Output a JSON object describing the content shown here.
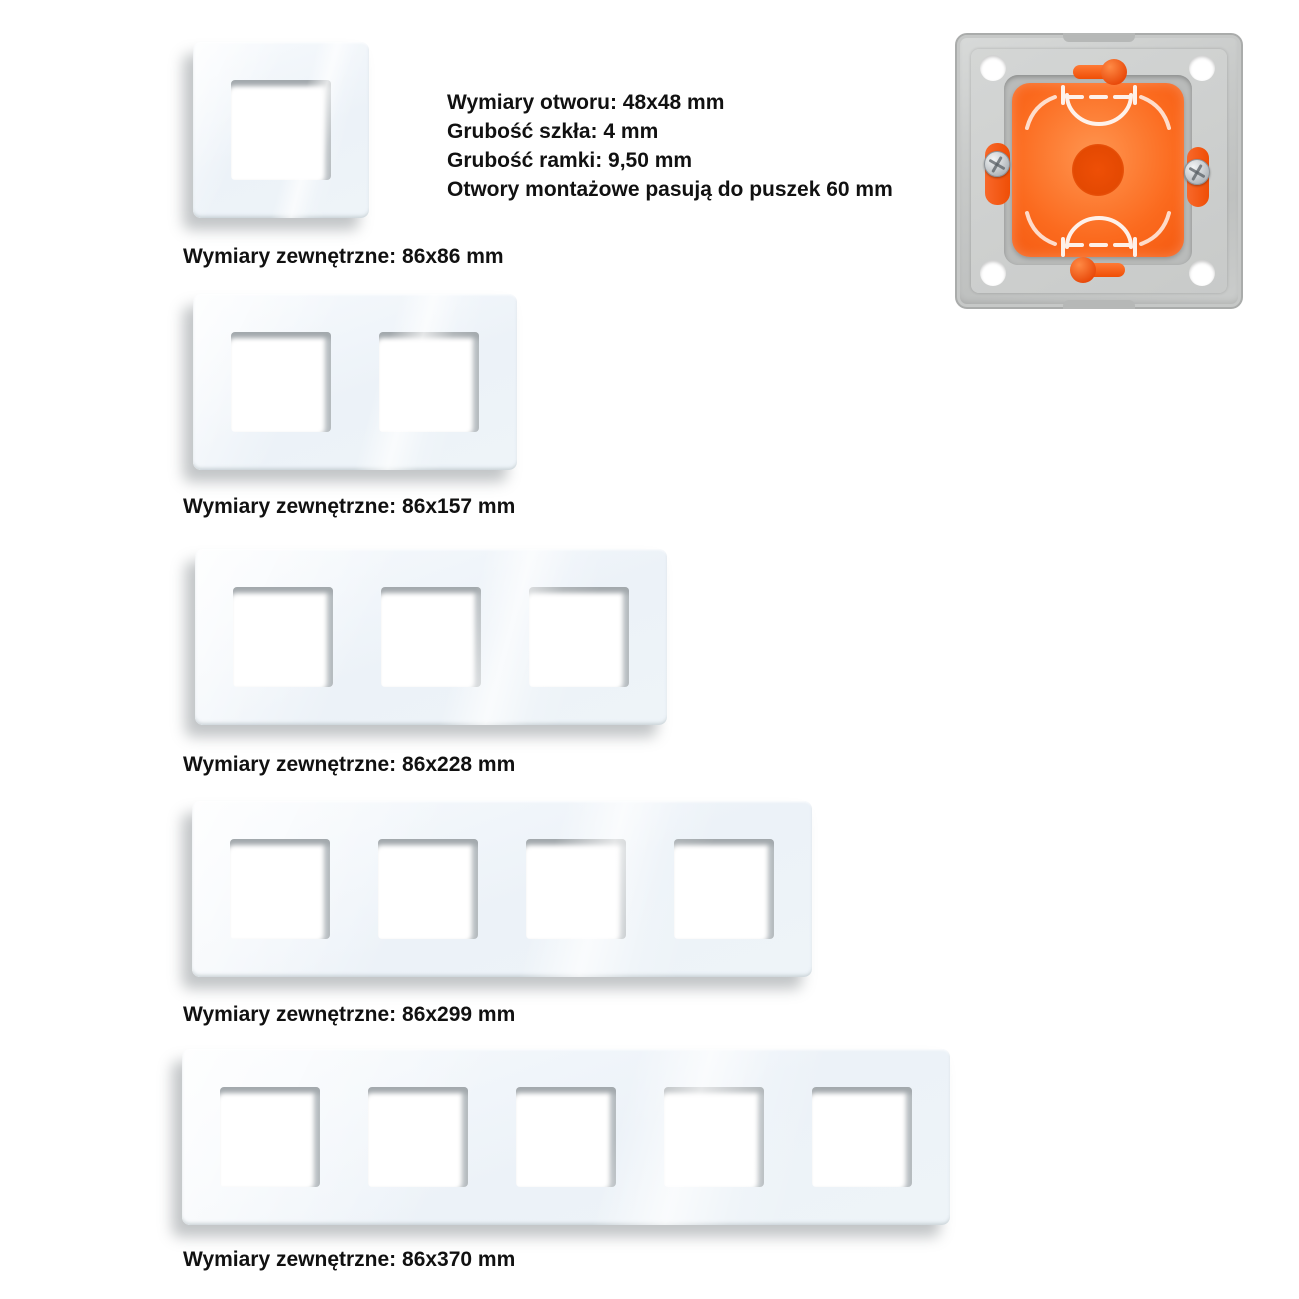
{
  "specs": {
    "lines": [
      "Wymiary otworu: 48x48 mm",
      "Grubość szkła: 4 mm",
      "Grubość ramki: 9,50 mm",
      "Otwory montażowe pasują do puszek 60 mm"
    ]
  },
  "frames": [
    {
      "gangs": 1,
      "label": "Wymiary zewnętrzne: 86x86 mm"
    },
    {
      "gangs": 2,
      "label": "Wymiary zewnętrzne: 86x157 mm"
    },
    {
      "gangs": 3,
      "label": "Wymiary zewnętrzne: 86x228 mm"
    },
    {
      "gangs": 4,
      "label": "Wymiary zewnętrzne: 86x299 mm"
    },
    {
      "gangs": 5,
      "label": "Wymiary zewnętrzne: 86x370 mm"
    }
  ],
  "mounting_box": {
    "name": "flush-mounting-frame-with-orange-box"
  },
  "colors": {
    "background": "#ffffff",
    "text": "#111111",
    "glass": "#eef3f8",
    "glass_highlight": "#ffffff",
    "cutout_shadow": "#a3a9ad",
    "box_orange": "#f1520a",
    "box_gray": "#c7c9c8"
  }
}
